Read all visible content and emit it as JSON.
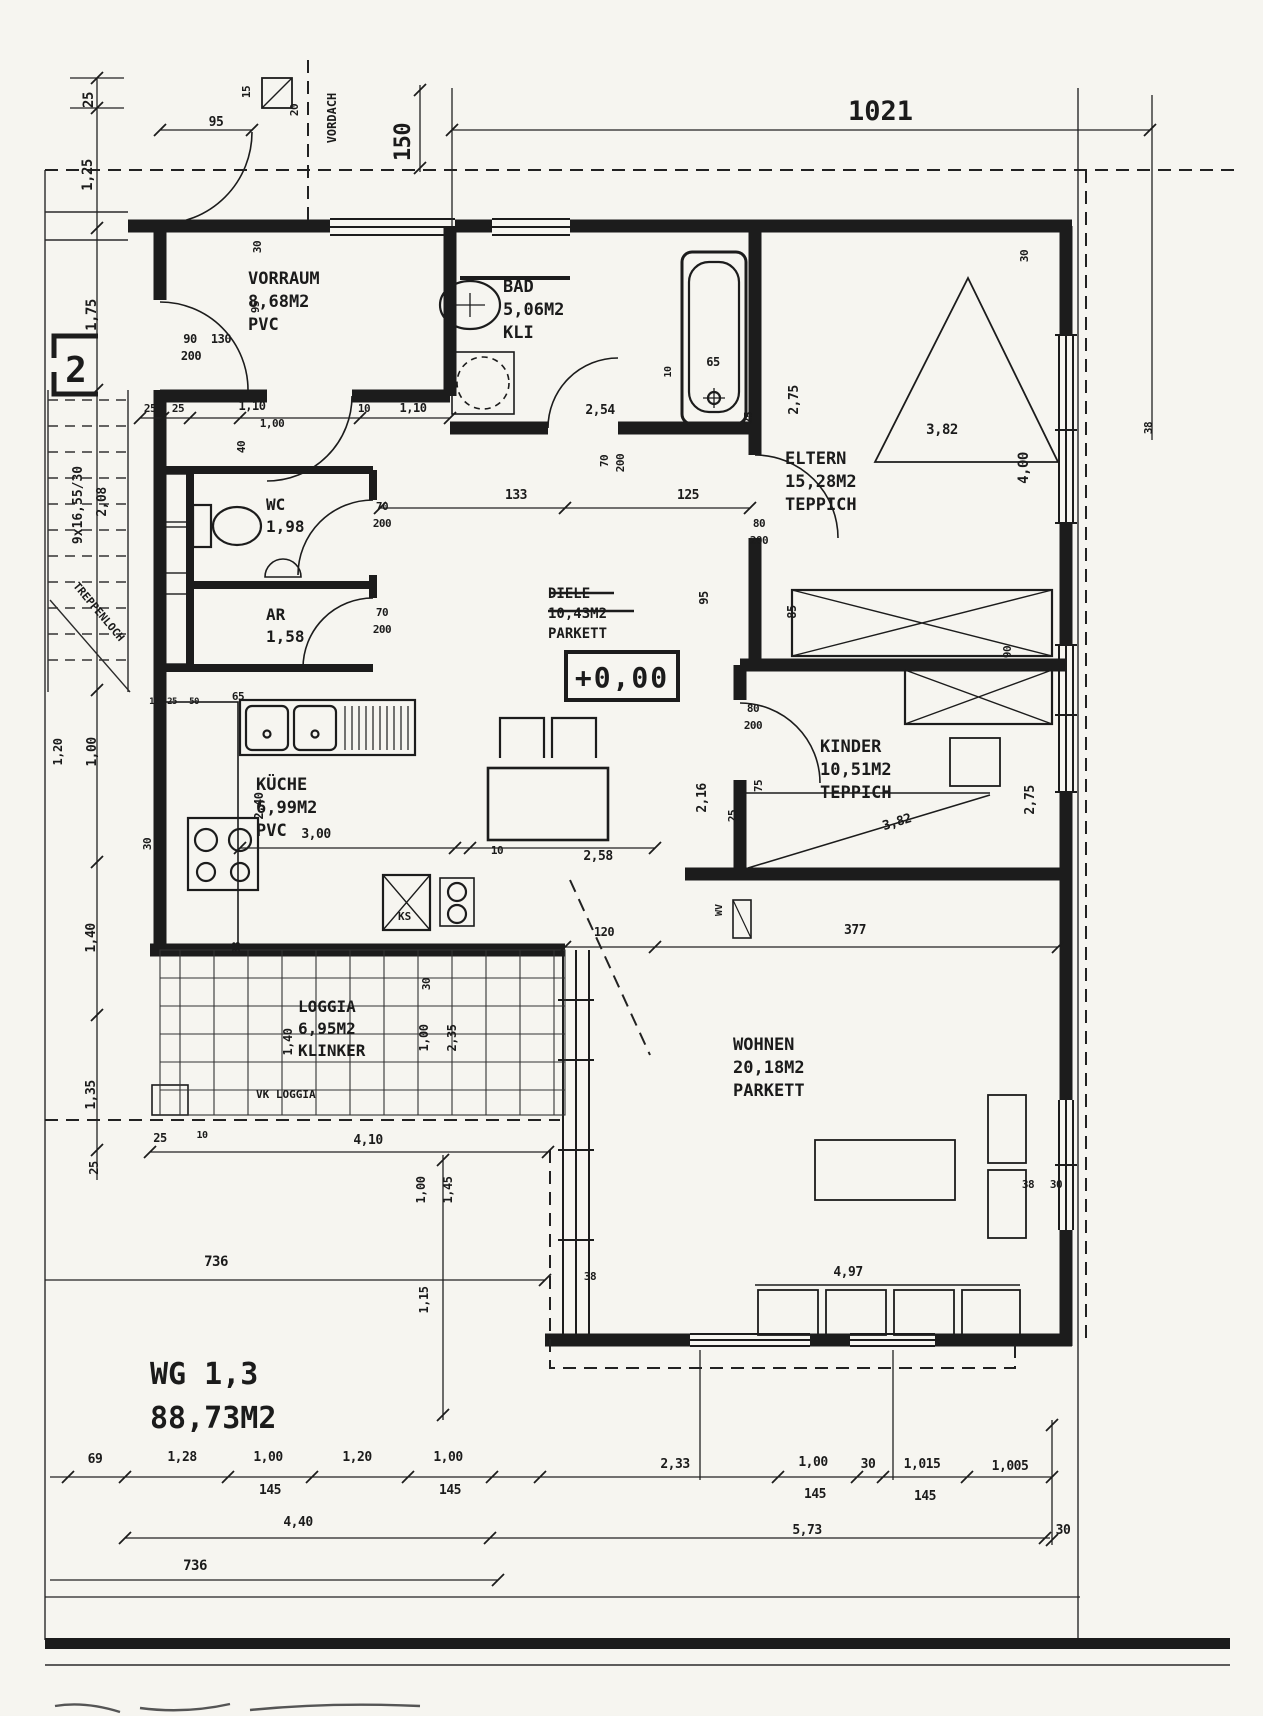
{
  "header": {
    "plan_number": "1021"
  },
  "apartment": {
    "staircase_number": "2",
    "name": "WG 1,3",
    "area": "88,73M2",
    "level_mark": "+0,00"
  },
  "rooms": [
    {
      "name": "VORRAUM",
      "area": "8,68M2",
      "floor": "PVC",
      "struck": false
    },
    {
      "name": "BAD",
      "area": "5,06M2",
      "floor": "KLI",
      "struck": false
    },
    {
      "name": "WC",
      "area": "1,98",
      "floor": "",
      "struck": false
    },
    {
      "name": "AR",
      "area": "1,58",
      "floor": "",
      "struck": false
    },
    {
      "name": "DIELE",
      "area": "10,43M2",
      "floor": "PARKETT",
      "struck": true
    },
    {
      "name": "KÜCHE",
      "area": "6,99M2",
      "floor": "PVC",
      "struck": false
    },
    {
      "name": "ELTERN",
      "area": "15,28M2",
      "floor": "TEPPICH",
      "struck": false
    },
    {
      "name": "KINDER",
      "area": "10,51M2",
      "floor": "TEPPICH",
      "struck": false
    },
    {
      "name": "LOGGIA",
      "area": "6,95M2",
      "floor": "KLINKER",
      "struck": false
    },
    {
      "name": "WOHNEN",
      "area": "20,18M2",
      "floor": "PARKETT",
      "struck": false
    }
  ],
  "annotations": {
    "vordach": "VORDACH",
    "vk_loggia": "VK LOGGIA",
    "treppenloch": "TREPPENLOCH",
    "stair_spec": "9x16,55/30",
    "fridge": "KS",
    "radiator": "WV"
  },
  "dim_labels": [
    {
      "t": "25",
      "x": 93,
      "y": 100,
      "r": -90,
      "s": 14
    },
    {
      "t": "1,25",
      "x": 92,
      "y": 175,
      "r": -90,
      "s": 14
    },
    {
      "t": "1,75",
      "x": 96,
      "y": 315,
      "r": -90,
      "s": 14
    },
    {
      "t": "95",
      "x": 216,
      "y": 126,
      "r": 0,
      "s": 13
    },
    {
      "t": "15",
      "x": 250,
      "y": 92,
      "r": -90,
      "s": 11
    },
    {
      "t": "20",
      "x": 298,
      "y": 110,
      "r": -90,
      "s": 11
    },
    {
      "t": "150",
      "x": 410,
      "y": 142,
      "r": -90,
      "s": 22
    },
    {
      "t": "30",
      "x": 261,
      "y": 247,
      "r": -90,
      "s": 11
    },
    {
      "t": "95",
      "x": 259,
      "y": 307,
      "r": -90,
      "s": 11
    },
    {
      "t": "90",
      "x": 190,
      "y": 343,
      "r": 0,
      "s": 12
    },
    {
      "t": "130",
      "x": 221,
      "y": 343,
      "r": 0,
      "s": 12
    },
    {
      "t": "200",
      "x": 191,
      "y": 360,
      "r": 0,
      "s": 12
    },
    {
      "t": "25",
      "x": 150,
      "y": 412,
      "r": 0,
      "s": 11
    },
    {
      "t": "25",
      "x": 178,
      "y": 412,
      "r": 0,
      "s": 11
    },
    {
      "t": "1,10",
      "x": 252,
      "y": 410,
      "r": 0,
      "s": 12
    },
    {
      "t": "1,00",
      "x": 272,
      "y": 427,
      "r": 0,
      "s": 11
    },
    {
      "t": "40",
      "x": 245,
      "y": 447,
      "r": -90,
      "s": 11
    },
    {
      "t": "10",
      "x": 364,
      "y": 412,
      "r": 0,
      "s": 11
    },
    {
      "t": "1,10",
      "x": 413,
      "y": 412,
      "r": 0,
      "s": 12
    },
    {
      "t": "2,54",
      "x": 600,
      "y": 414,
      "r": 0,
      "s": 13
    },
    {
      "t": "70",
      "x": 608,
      "y": 461,
      "r": -90,
      "s": 11
    },
    {
      "t": "200",
      "x": 624,
      "y": 463,
      "r": -90,
      "s": 11
    },
    {
      "t": "65",
      "x": 713,
      "y": 366,
      "r": 0,
      "s": 12
    },
    {
      "t": "10",
      "x": 671,
      "y": 372,
      "r": -90,
      "s": 10
    },
    {
      "t": "25",
      "x": 752,
      "y": 418,
      "r": -90,
      "s": 11
    },
    {
      "t": "133",
      "x": 516,
      "y": 499,
      "r": 0,
      "s": 13
    },
    {
      "t": "125",
      "x": 688,
      "y": 499,
      "r": 0,
      "s": 13
    },
    {
      "t": "80",
      "x": 759,
      "y": 527,
      "r": 0,
      "s": 11
    },
    {
      "t": "200",
      "x": 759,
      "y": 544,
      "r": 0,
      "s": 11
    },
    {
      "t": "95",
      "x": 708,
      "y": 598,
      "r": -90,
      "s": 12
    },
    {
      "t": "85",
      "x": 796,
      "y": 612,
      "r": -90,
      "s": 12
    },
    {
      "t": "2,75",
      "x": 798,
      "y": 400,
      "r": -90,
      "s": 13
    },
    {
      "t": "3,82",
      "x": 942,
      "y": 434,
      "r": 0,
      "s": 14
    },
    {
      "t": "4,00",
      "x": 1028,
      "y": 468,
      "r": -90,
      "s": 14
    },
    {
      "t": "30",
      "x": 1028,
      "y": 256,
      "r": -90,
      "s": 11
    },
    {
      "t": "38",
      "x": 1152,
      "y": 428,
      "r": -90,
      "s": 11
    },
    {
      "t": "90",
      "x": 1011,
      "y": 652,
      "r": -90,
      "s": 11
    },
    {
      "t": "70",
      "x": 382,
      "y": 510,
      "r": 0,
      "s": 11
    },
    {
      "t": "200",
      "x": 382,
      "y": 527,
      "r": 0,
      "s": 11
    },
    {
      "t": "70",
      "x": 382,
      "y": 616,
      "r": 0,
      "s": 11
    },
    {
      "t": "200",
      "x": 382,
      "y": 633,
      "r": 0,
      "s": 11
    },
    {
      "t": "80",
      "x": 753,
      "y": 712,
      "r": 0,
      "s": 11
    },
    {
      "t": "200",
      "x": 753,
      "y": 729,
      "r": 0,
      "s": 11
    },
    {
      "t": "2,16",
      "x": 706,
      "y": 798,
      "r": -90,
      "s": 13
    },
    {
      "t": "25",
      "x": 736,
      "y": 816,
      "r": -90,
      "s": 11
    },
    {
      "t": "75",
      "x": 762,
      "y": 786,
      "r": -90,
      "s": 11
    },
    {
      "t": "3,82",
      "x": 898,
      "y": 826,
      "r": -17,
      "s": 13
    },
    {
      "t": "2,75",
      "x": 1034,
      "y": 800,
      "r": -90,
      "s": 13
    },
    {
      "t": "65",
      "x": 238,
      "y": 700,
      "r": 0,
      "s": 11
    },
    {
      "t": "12",
      "x": 154,
      "y": 704,
      "r": 0,
      "s": 9
    },
    {
      "t": "25",
      "x": 172,
      "y": 704,
      "r": 0,
      "s": 9
    },
    {
      "t": "50",
      "x": 194,
      "y": 704,
      "r": 0,
      "s": 9
    },
    {
      "t": "2,40",
      "x": 263,
      "y": 806,
      "r": -90,
      "s": 12
    },
    {
      "t": "3,00",
      "x": 316,
      "y": 838,
      "r": 0,
      "s": 13
    },
    {
      "t": "30",
      "x": 151,
      "y": 844,
      "r": -90,
      "s": 11
    },
    {
      "t": "38",
      "x": 240,
      "y": 948,
      "r": -90,
      "s": 11
    },
    {
      "t": "10",
      "x": 497,
      "y": 854,
      "r": 0,
      "s": 11
    },
    {
      "t": "2,58",
      "x": 598,
      "y": 860,
      "r": 0,
      "s": 13
    },
    {
      "t": "120",
      "x": 604,
      "y": 936,
      "r": 0,
      "s": 12
    },
    {
      "t": "377",
      "x": 855,
      "y": 934,
      "r": 0,
      "s": 13
    },
    {
      "t": "1,20",
      "x": 62,
      "y": 752,
      "r": -90,
      "s": 12
    },
    {
      "t": "1,00",
      "x": 96,
      "y": 752,
      "r": -90,
      "s": 13
    },
    {
      "t": "1,40",
      "x": 95,
      "y": 938,
      "r": -90,
      "s": 13
    },
    {
      "t": "1,35",
      "x": 95,
      "y": 1095,
      "r": -90,
      "s": 13
    },
    {
      "t": "25",
      "x": 98,
      "y": 1168,
      "r": -90,
      "s": 12
    },
    {
      "t": "2,08",
      "x": 106,
      "y": 502,
      "r": -90,
      "s": 13
    },
    {
      "t": "1,40",
      "x": 292,
      "y": 1042,
      "r": -90,
      "s": 12
    },
    {
      "t": "1,00",
      "x": 428,
      "y": 1038,
      "r": -90,
      "s": 12
    },
    {
      "t": "2,35",
      "x": 456,
      "y": 1038,
      "r": -90,
      "s": 12
    },
    {
      "t": "30",
      "x": 430,
      "y": 984,
      "r": -90,
      "s": 11
    },
    {
      "t": "25",
      "x": 160,
      "y": 1142,
      "r": 0,
      "s": 12
    },
    {
      "t": "10",
      "x": 202,
      "y": 1138,
      "r": 0,
      "s": 10
    },
    {
      "t": "4,10",
      "x": 368,
      "y": 1144,
      "r": 0,
      "s": 13
    },
    {
      "t": "736",
      "x": 216,
      "y": 1266,
      "r": 0,
      "s": 14
    },
    {
      "t": "1,00",
      "x": 425,
      "y": 1190,
      "r": -90,
      "s": 12
    },
    {
      "t": "1,45",
      "x": 452,
      "y": 1190,
      "r": -90,
      "s": 12
    },
    {
      "t": "1,15",
      "x": 428,
      "y": 1300,
      "r": -90,
      "s": 12
    },
    {
      "t": "38",
      "x": 590,
      "y": 1280,
      "r": 0,
      "s": 11
    },
    {
      "t": "4,97",
      "x": 848,
      "y": 1276,
      "r": 0,
      "s": 13
    },
    {
      "t": "38",
      "x": 1028,
      "y": 1188,
      "r": 0,
      "s": 11
    },
    {
      "t": "30",
      "x": 1056,
      "y": 1188,
      "r": 0,
      "s": 11
    },
    {
      "t": "69",
      "x": 95,
      "y": 1463,
      "r": 0,
      "s": 13
    },
    {
      "t": "1,28",
      "x": 182,
      "y": 1461,
      "r": 0,
      "s": 13
    },
    {
      "t": "1,00",
      "x": 268,
      "y": 1461,
      "r": 0,
      "s": 13
    },
    {
      "t": "145",
      "x": 270,
      "y": 1494,
      "r": 0,
      "s": 13
    },
    {
      "t": "1,20",
      "x": 357,
      "y": 1461,
      "r": 0,
      "s": 13
    },
    {
      "t": "1,00",
      "x": 448,
      "y": 1461,
      "r": 0,
      "s": 13
    },
    {
      "t": "145",
      "x": 450,
      "y": 1494,
      "r": 0,
      "s": 13
    },
    {
      "t": "2,33",
      "x": 675,
      "y": 1468,
      "r": 0,
      "s": 13
    },
    {
      "t": "1,00",
      "x": 813,
      "y": 1466,
      "r": 0,
      "s": 13
    },
    {
      "t": "145",
      "x": 815,
      "y": 1498,
      "r": 0,
      "s": 13
    },
    {
      "t": "30",
      "x": 868,
      "y": 1468,
      "r": 0,
      "s": 13
    },
    {
      "t": "1,015",
      "x": 922,
      "y": 1468,
      "r": 0,
      "s": 13
    },
    {
      "t": "145",
      "x": 925,
      "y": 1500,
      "r": 0,
      "s": 13
    },
    {
      "t": "1,005",
      "x": 1010,
      "y": 1470,
      "r": 0,
      "s": 13
    },
    {
      "t": "4,40",
      "x": 298,
      "y": 1526,
      "r": 0,
      "s": 13
    },
    {
      "t": "5,73",
      "x": 807,
      "y": 1534,
      "r": 0,
      "s": 13
    },
    {
      "t": "30",
      "x": 1063,
      "y": 1534,
      "r": 0,
      "s": 13
    },
    {
      "t": "736",
      "x": 195,
      "y": 1570,
      "r": 0,
      "s": 14
    }
  ]
}
